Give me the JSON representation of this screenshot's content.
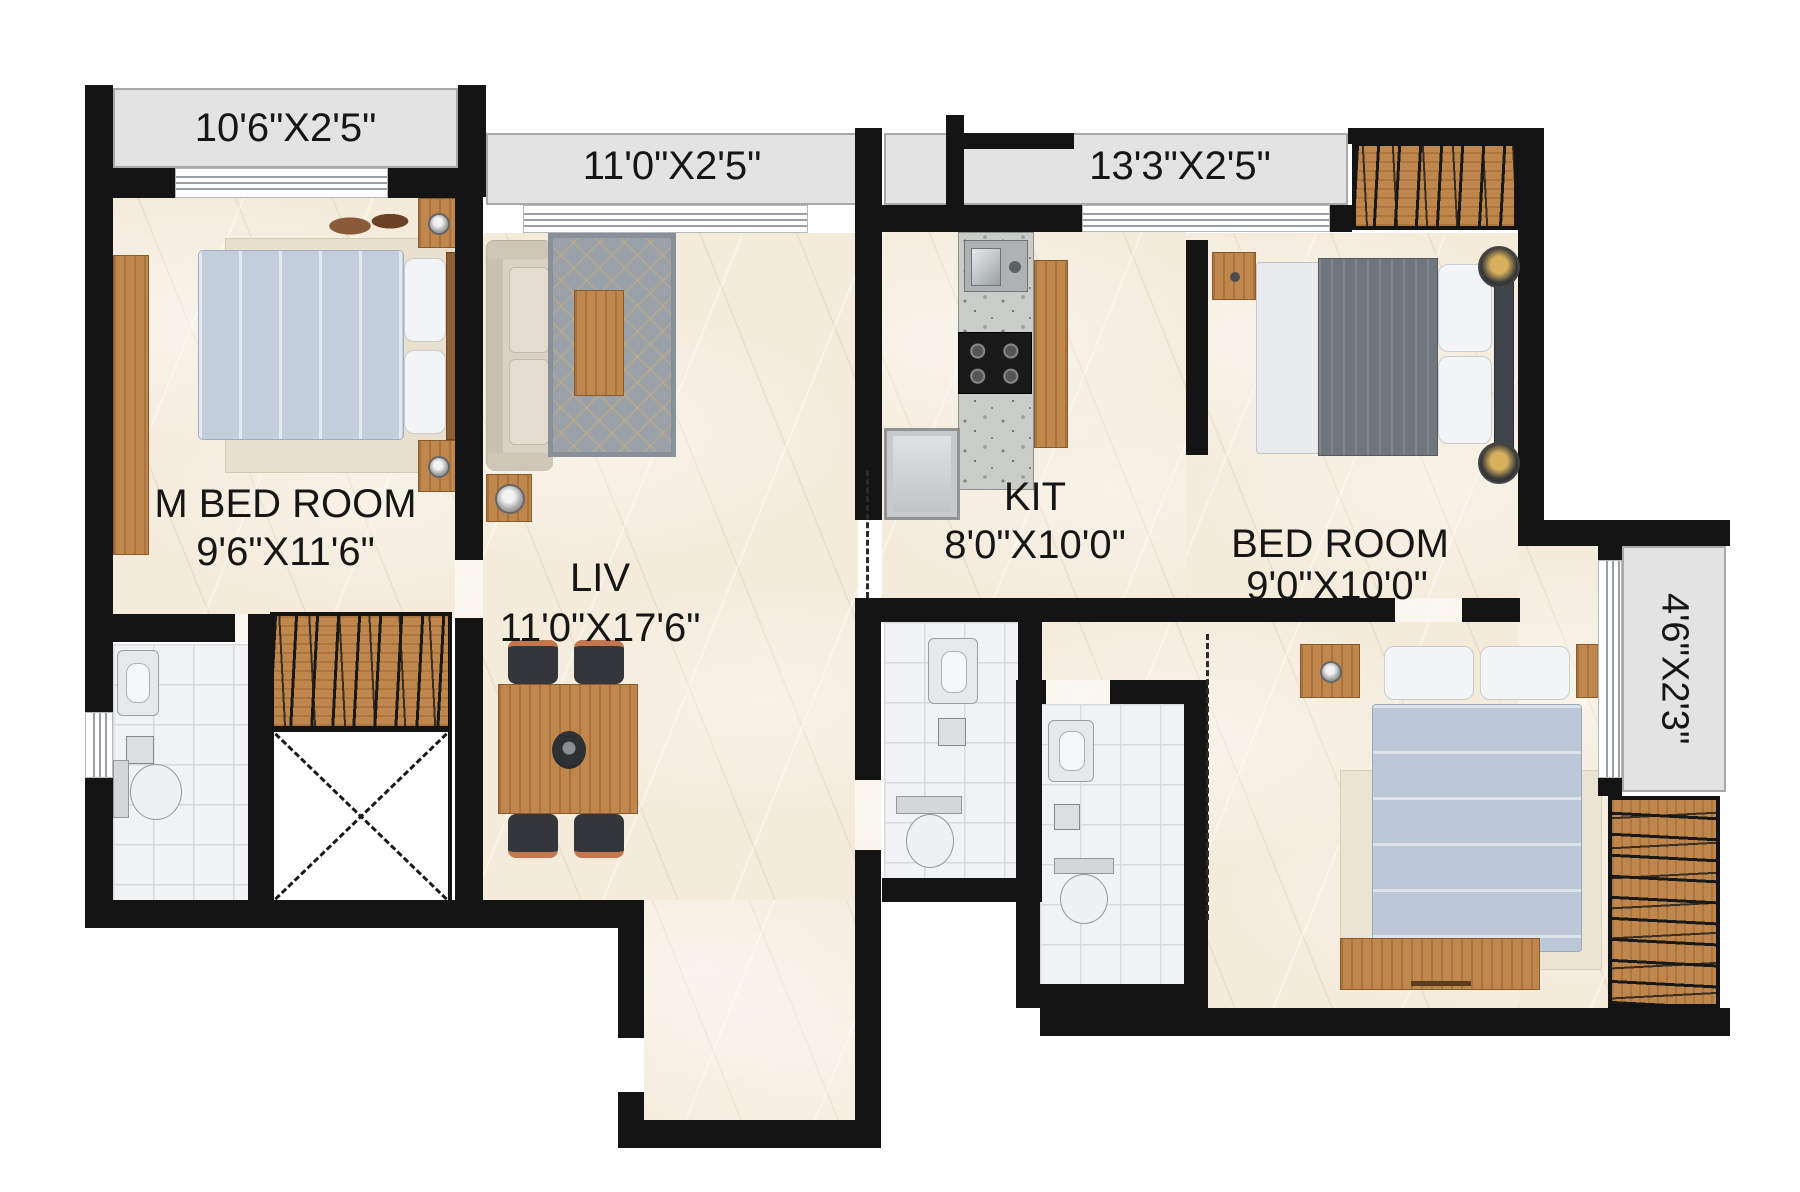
{
  "rooms": {
    "m_bed_room": {
      "label": "M BED ROOM",
      "size": "9'6\"X11'6\""
    },
    "living": {
      "label": "LIV",
      "size": "11'0\"X17'6\""
    },
    "kitchen": {
      "label": "KIT",
      "size": "8'0\"X10'0\""
    },
    "bed_room": {
      "label": "BED ROOM",
      "size": "9'0\"X10'0\""
    }
  },
  "balconies": {
    "top_left": {
      "size": "10'6\"X2'5\""
    },
    "top_center": {
      "size": "11'0\"X2'5\""
    },
    "top_right": {
      "size": "13'3\"X2'5\""
    },
    "right_side": {
      "size": "4'6\"X2'3\""
    }
  },
  "colors": {
    "wall": "#141414",
    "floor_marble": "#f4ebdb",
    "balcony": "#e3e3e3",
    "bathroom_tile": "#f1f2f4",
    "wood": "#c0874d",
    "bed_linen": "#c3cedd",
    "dark_bed": "#70767e",
    "label_text": "#161616"
  }
}
